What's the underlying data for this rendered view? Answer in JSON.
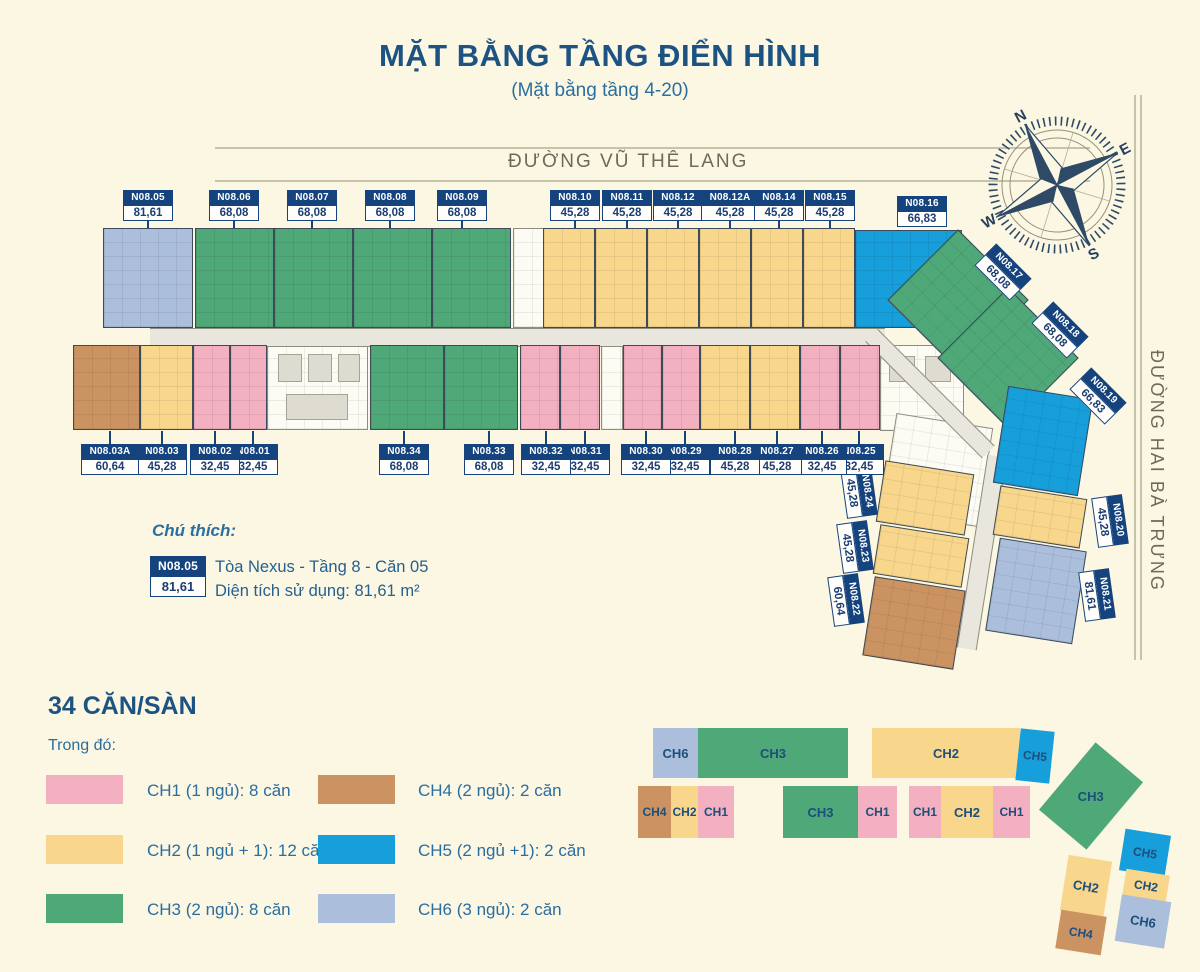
{
  "title": {
    "main": "MẶT BẰNG TẦNG ĐIỂN HÌNH",
    "sub": "(Mặt bằng tầng 4-20)"
  },
  "streets": {
    "top": "ĐƯỜNG VŨ THÊ LANG",
    "right": "ĐƯỜNG HAI BÀ TRƯNG"
  },
  "compass": {
    "n": "N",
    "e": "E",
    "s": "S",
    "w": "W"
  },
  "plan": {
    "units": [
      {
        "id": "N08.05",
        "area": "81,61"
      },
      {
        "id": "N08.06",
        "area": "68,08"
      },
      {
        "id": "N08.07",
        "area": "68,08"
      },
      {
        "id": "N08.08",
        "area": "68,08"
      },
      {
        "id": "N08.09",
        "area": "68,08"
      },
      {
        "id": "N08.10",
        "area": "45,28"
      },
      {
        "id": "N08.11",
        "area": "45,28"
      },
      {
        "id": "N08.12",
        "area": "45,28"
      },
      {
        "id": "N08.12A",
        "area": "45,28"
      },
      {
        "id": "N08.14",
        "area": "45,28"
      },
      {
        "id": "N08.15",
        "area": "45,28"
      },
      {
        "id": "N08.16",
        "area": "66,83"
      },
      {
        "id": "N08.17",
        "area": "68,08"
      },
      {
        "id": "N08.18",
        "area": "68,08"
      },
      {
        "id": "N08.19",
        "area": "66,83"
      },
      {
        "id": "N08.20",
        "area": "45,28"
      },
      {
        "id": "N08.21",
        "area": "81,61"
      },
      {
        "id": "N08.22",
        "area": "60,64"
      },
      {
        "id": "N08.23",
        "area": "45,28"
      },
      {
        "id": "N08.24",
        "area": "45,28"
      },
      {
        "id": "N08.25",
        "area": "32,45"
      },
      {
        "id": "N08.26",
        "area": "32,45"
      },
      {
        "id": "N08.27",
        "area": "45,28"
      },
      {
        "id": "N08.28",
        "area": "45,28"
      },
      {
        "id": "N08.29",
        "area": "32,45"
      },
      {
        "id": "N08.30",
        "area": "32,45"
      },
      {
        "id": "N08.31",
        "area": "32,45"
      },
      {
        "id": "N08.32",
        "area": "32,45"
      },
      {
        "id": "N08.33",
        "area": "68,08"
      },
      {
        "id": "N08.34",
        "area": "68,08"
      },
      {
        "id": "N08.01",
        "area": "32,45"
      },
      {
        "id": "N08.02",
        "area": "32,45"
      },
      {
        "id": "N08.03",
        "area": "45,28"
      },
      {
        "id": "N08.03A",
        "area": "60,64"
      }
    ]
  },
  "note": {
    "heading": "Chú thích:",
    "sample_id": "N08.05",
    "sample_area": "81,61",
    "line1": "Tòa Nexus - Tầng 8 - Căn 05",
    "line2": "Diện tích sử dụng: 81,61 m²"
  },
  "summary": {
    "heading": "34 CĂN/SÀN",
    "sub": "Trong đó:"
  },
  "unit_types": [
    {
      "code": "CH1",
      "label": "CH1 (1 ngủ): 8 căn",
      "color": "#f3b0c1"
    },
    {
      "code": "CH2",
      "label": "CH2 (1 ngủ + 1): 12 căn",
      "color": "#f8d78c"
    },
    {
      "code": "CH3",
      "label": "CH3 (2 ngủ): 8 căn",
      "color": "#4fa878"
    },
    {
      "code": "CH4",
      "label": "CH4 (2 ngủ): 2 căn",
      "color": "#cc9362"
    },
    {
      "code": "CH5",
      "label": "CH5 (2 ngủ +1): 2 căn",
      "color": "#169fda"
    },
    {
      "code": "CH6",
      "label": "CH6 (3 ngủ): 2 căn",
      "color": "#abbedb"
    }
  ]
}
